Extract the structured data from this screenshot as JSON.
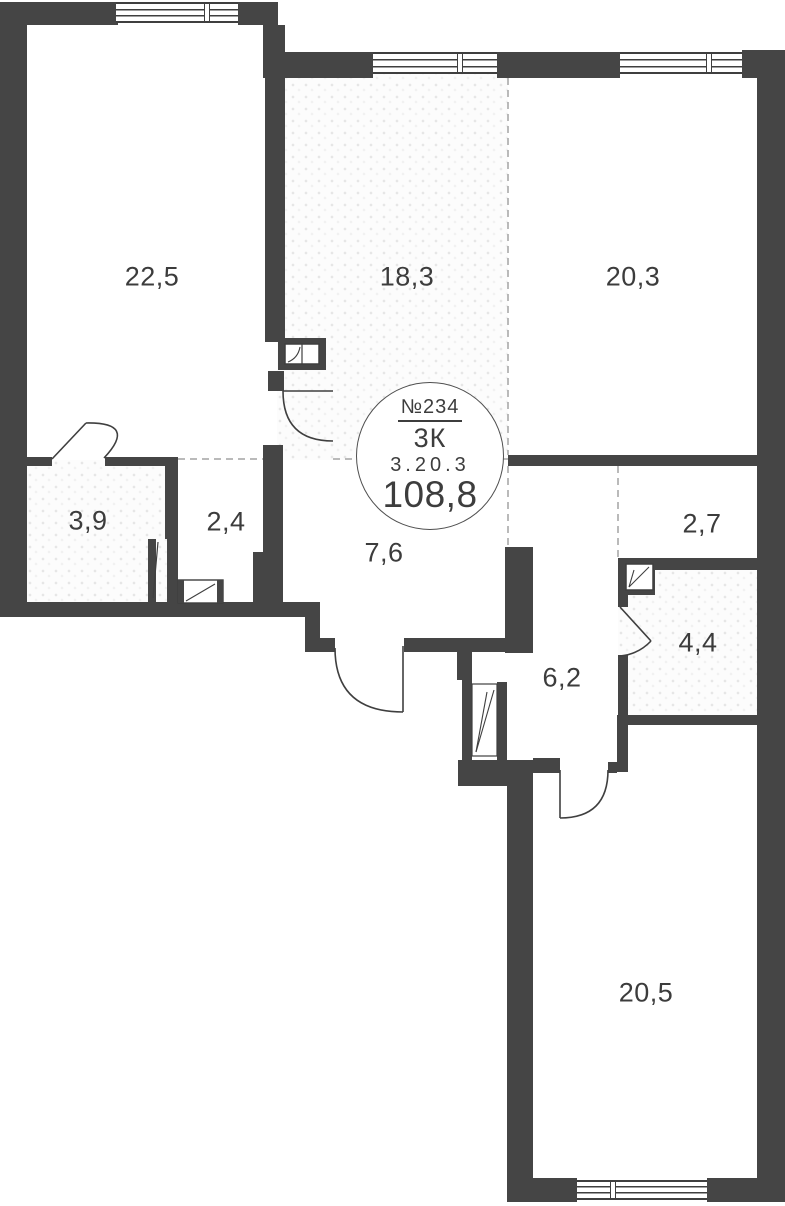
{
  "plan": {
    "badge": {
      "unit_number": "№234",
      "rooms_count": "3К",
      "unit_code": "3.20.3",
      "total_area": "108,8"
    },
    "rooms": [
      {
        "name": "room-top-left",
        "area": "22,5"
      },
      {
        "name": "room-top-middle",
        "area": "18,3"
      },
      {
        "name": "room-top-right",
        "area": "20,3"
      },
      {
        "name": "bathroom-left",
        "area": "3,9"
      },
      {
        "name": "wardrobe",
        "area": "2,4"
      },
      {
        "name": "hallway",
        "area": "7,6"
      },
      {
        "name": "corridor-right",
        "area": "2,7"
      },
      {
        "name": "bathroom-right",
        "area": "4,4"
      },
      {
        "name": "corridor-center",
        "area": "6,2"
      },
      {
        "name": "room-bottom",
        "area": "20,5"
      }
    ],
    "colors": {
      "wall": "#454545",
      "line": "#3f3f3f",
      "dash": "#a3a3a3",
      "background": "#ffffff"
    }
  }
}
